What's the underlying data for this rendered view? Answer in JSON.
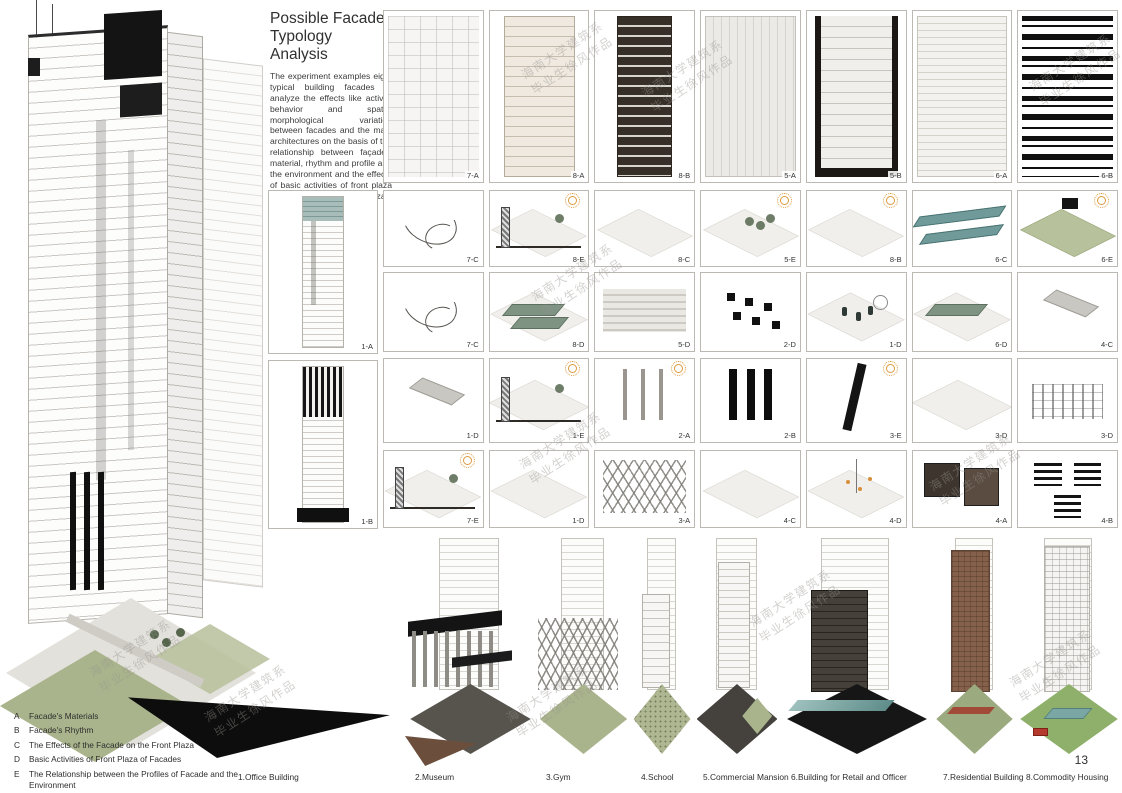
{
  "title": "Possible Facade Typology Analysis",
  "intro": "The experiment examples eight typical building facades to analyze the effects like activity behavior and spatial morphological variation between facades and the main architectures on the basis of the relationship between façade's material, rhythm and profile and the environment and the effects of basic activities of front plaza and facades on the front plaza.",
  "page_number": "13",
  "watermark": {
    "line1": "海南大学建筑系",
    "line2": "毕业生徐风作品"
  },
  "legend": [
    {
      "key": "A",
      "text": "Facade's Materials"
    },
    {
      "key": "B",
      "text": "Facade's Rhythm"
    },
    {
      "key": "C",
      "text": "The Effects of the Facade on the Front Plaza"
    },
    {
      "key": "D",
      "text": "Basic Activities of Front Plaza of Facades"
    },
    {
      "key": "E",
      "text": "The Relationship between the Profiles of Facade and the Environment"
    }
  ],
  "side_cells": [
    {
      "label": "1-A",
      "motif": "towerA"
    },
    {
      "label": "1-B",
      "motif": "towerB"
    }
  ],
  "grid": {
    "rows": [
      {
        "cells": [
          {
            "label": "7-A",
            "motif": "elev1"
          },
          {
            "label": "8-A",
            "motif": "elev2"
          },
          {
            "label": "8-B",
            "motif": "elev3"
          },
          {
            "label": "5-A",
            "motif": "elev4"
          },
          {
            "label": "5-B",
            "motif": "elev5"
          },
          {
            "label": "6-A",
            "motif": "elev6"
          },
          {
            "label": "6-B",
            "motif": "elev7"
          }
        ]
      },
      {
        "cells": [
          {
            "label": "7-C",
            "motif": "arrows"
          },
          {
            "label": "8-E",
            "motif": "section",
            "sun": true
          },
          {
            "label": "8-C",
            "motif": "diamond"
          },
          {
            "label": "5-E",
            "motif": "trees",
            "sun": true
          },
          {
            "label": "8-B",
            "motif": "diamond",
            "sun": true
          },
          {
            "label": "6-C",
            "motif": "tealbars"
          },
          {
            "label": "6-E",
            "motif": "blockgreen",
            "sun": true
          }
        ]
      },
      {
        "cells": [
          {
            "label": "7-C",
            "motif": "arrows"
          },
          {
            "label": "8-D",
            "motif": "tealslabs"
          },
          {
            "label": "5-D",
            "motif": "stripes"
          },
          {
            "label": "2-D",
            "motif": "blacksquares"
          },
          {
            "label": "1-D",
            "motif": "cylinders"
          },
          {
            "label": "6-D",
            "motif": "tealbar"
          },
          {
            "label": "4-C",
            "motif": "greyslab"
          }
        ]
      },
      {
        "cells": [
          {
            "label": "1-D",
            "motif": "greyslab"
          },
          {
            "label": "1-E",
            "motif": "section",
            "sun": true
          },
          {
            "label": "2-A",
            "motif": "greycols",
            "sun": true
          },
          {
            "label": "2-B",
            "motif": "blackcols"
          },
          {
            "label": "3-E",
            "motif": "diag",
            "sun": true
          },
          {
            "label": "3-D",
            "motif": "diamond"
          },
          {
            "label": "3-D",
            "motif": "scatter"
          }
        ]
      },
      {
        "cells": [
          {
            "label": "7-E",
            "motif": "section",
            "sun": true
          },
          {
            "label": "1-D",
            "motif": "diamond"
          },
          {
            "label": "3-A",
            "motif": "truss"
          },
          {
            "label": "4-C",
            "motif": "diamond"
          },
          {
            "label": "4-D",
            "motif": "orangedots"
          },
          {
            "label": "4-A",
            "motif": "photos"
          },
          {
            "label": "4-B",
            "motif": "barcode"
          }
        ]
      }
    ]
  },
  "bottom_buildings": [
    {
      "label": "1.Office Building"
    },
    {
      "label": "2.Museum"
    },
    {
      "label": "3.Gym"
    },
    {
      "label": "4.School"
    },
    {
      "label": "5.Commercial Mansion"
    },
    {
      "label": "6.Building for Retail and Officer"
    },
    {
      "label": "7.Residential Building"
    },
    {
      "label": "8.Commodity Housing"
    }
  ],
  "colors": {
    "teal": "#6f9a99",
    "sun_orange": "#dd9a3f",
    "lawn_green": "#a9b48c",
    "brick_brown": "#85604a",
    "ink_black": "#141414"
  }
}
